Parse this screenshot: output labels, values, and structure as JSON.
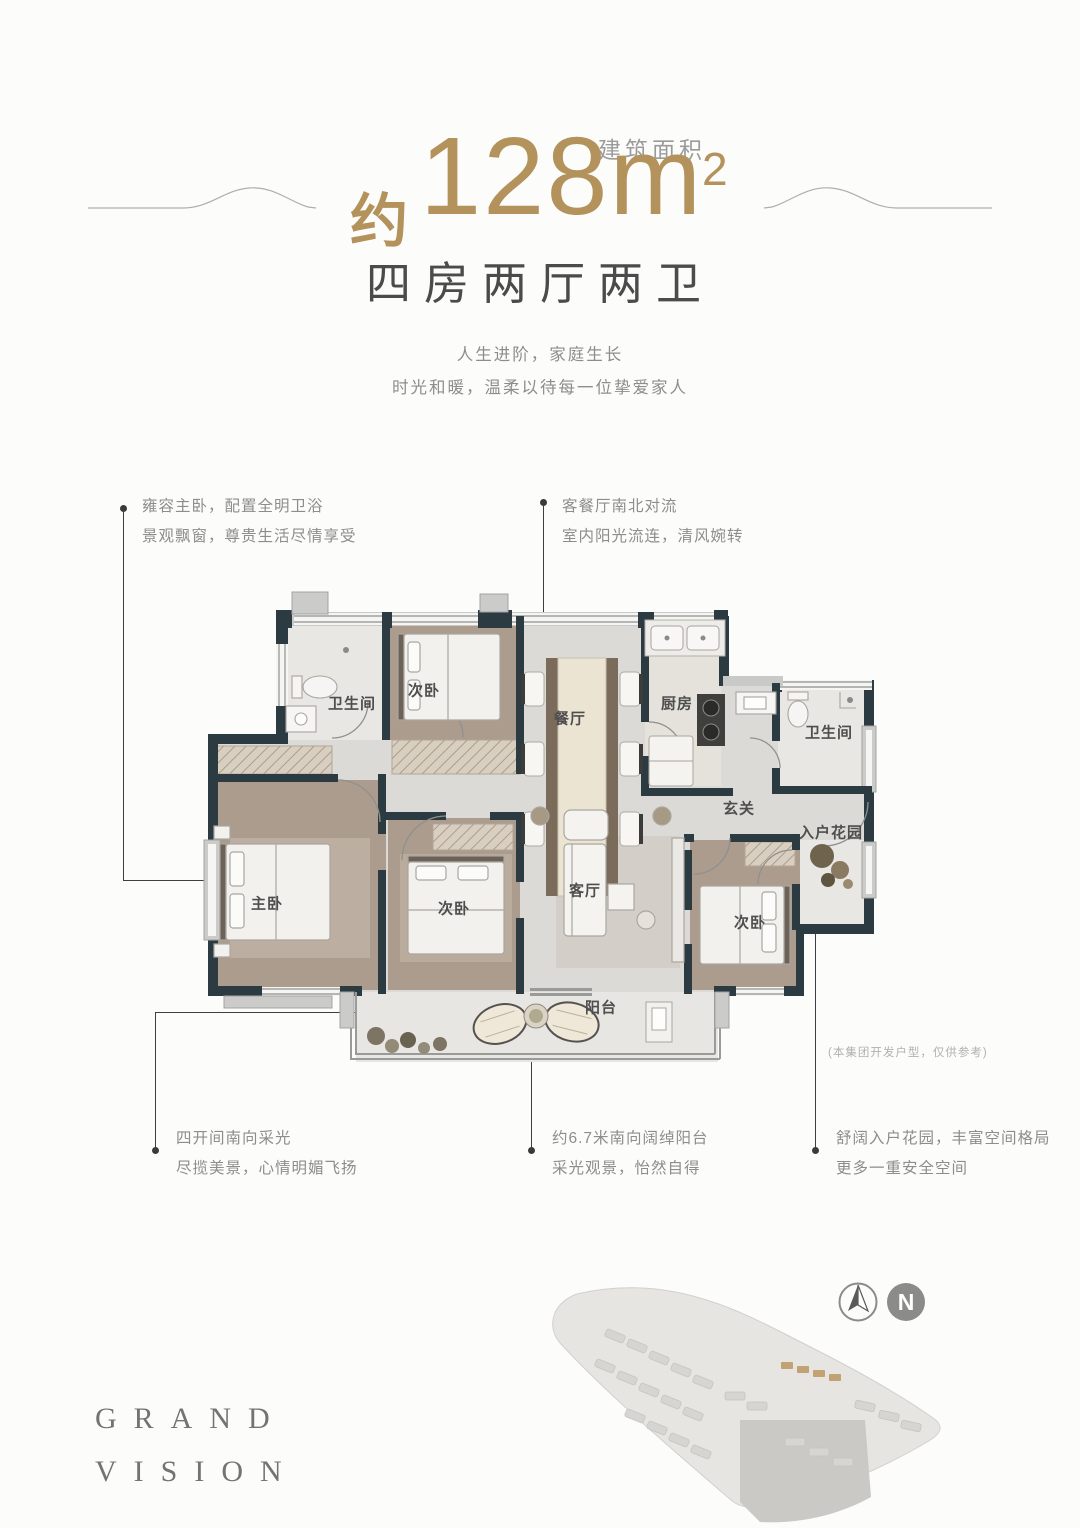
{
  "poster": {
    "header": {
      "area_about": "约",
      "area_number": "128m",
      "area_exponent": "2",
      "area_label": "建筑面积",
      "layout_title": "四房两厅两卫",
      "tagline1": "人生进阶，家庭生长",
      "tagline2": "时光和暖，温柔以待每一位挚爱家人"
    },
    "callouts": {
      "master": {
        "line1": "雍容主卧，配置全明卫浴",
        "line2": "景观飘窗，尊贵生活尽情享受"
      },
      "living_dining": {
        "line1": "客餐厅南北对流",
        "line2": "室内阳光流连，清风婉转"
      },
      "south_bays": {
        "line1": "四开间南向采光",
        "line2": "尽揽美景，心情明媚飞扬"
      },
      "balcony": {
        "line1": "约6.7米南向阔绰阳台",
        "line2": "采光观景，怡然自得"
      },
      "entry_garden": {
        "line1": "舒阔入户花园，丰富空间格局",
        "line2": "更多一重安全空间"
      }
    },
    "floorplan": {
      "disclaimer": "(本集团开发户型，仅供参考)",
      "rooms": [
        {
          "id": "bath-1",
          "label": "卫生间"
        },
        {
          "id": "bedroom-north",
          "label": "次卧"
        },
        {
          "id": "dining",
          "label": "餐厅"
        },
        {
          "id": "kitchen",
          "label": "厨房"
        },
        {
          "id": "bath-2",
          "label": "卫生间"
        },
        {
          "id": "foyer",
          "label": "玄关"
        },
        {
          "id": "entry-garden",
          "label": "入户花园"
        },
        {
          "id": "master-bedroom",
          "label": "主卧"
        },
        {
          "id": "bedroom-middle",
          "label": "次卧"
        },
        {
          "id": "living",
          "label": "客厅"
        },
        {
          "id": "bedroom-east",
          "label": "次卧"
        },
        {
          "id": "balcony",
          "label": "阳台"
        }
      ]
    },
    "footer": {
      "brand_word1": "GRAND",
      "brand_word2": "VISION",
      "compass_north": "N"
    },
    "colors": {
      "accent_gold": "#b3925c",
      "wall_dark": "#2c3b42",
      "text_dark": "#4b4b4b",
      "text_gray": "#8d8d8d"
    }
  }
}
